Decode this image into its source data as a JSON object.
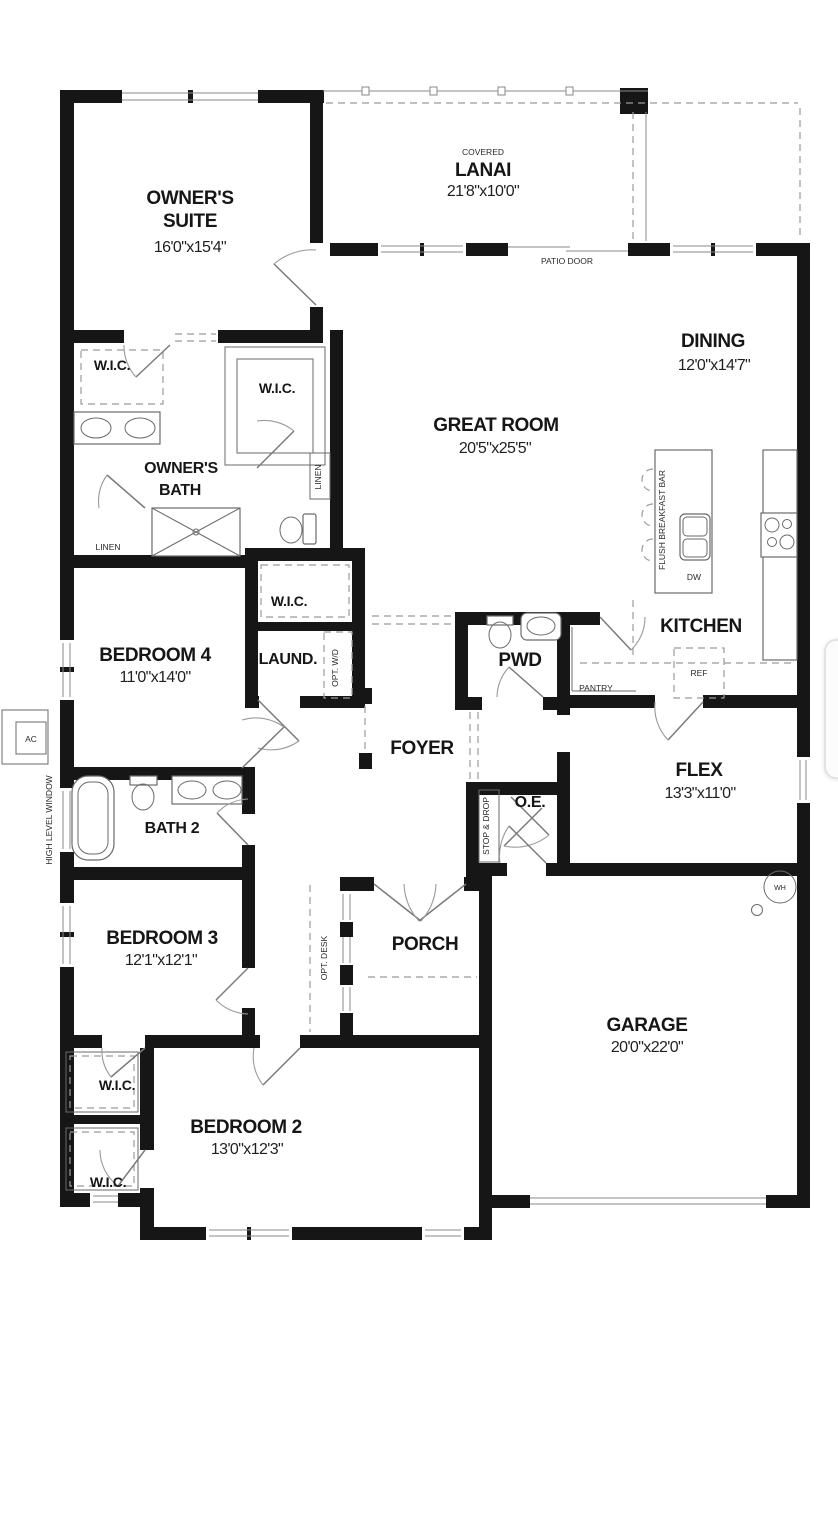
{
  "colors": {
    "background": "#ffffff",
    "wall": "#161616",
    "thin_line": "#8a8a8a",
    "dashed_line": "#9b9b9b",
    "text": "#161616",
    "overlay_border": "#e3e3e3"
  },
  "labels": {
    "owners_suite": {
      "name1": "OWNER'S",
      "name2": "SUITE",
      "dims": "16'0\"x15'4\""
    },
    "lanai": {
      "prefix": "COVERED",
      "name": "LANAI",
      "dims": "21'8\"x10'0\""
    },
    "patio_door": "PATIO DOOR",
    "dining": {
      "name": "DINING",
      "dims": "12'0\"x14'7\""
    },
    "great_room": {
      "name": "GREAT ROOM",
      "dims": "20'5\"x25'5\""
    },
    "kitchen": {
      "name": "KITCHEN"
    },
    "breakfast_bar": "FLUSH BREAKFAST BAR",
    "dw": "DW",
    "ref": "REF",
    "pantry": "PANTRY",
    "wic": "W.I.C.",
    "owners_bath": {
      "name1": "OWNER'S",
      "name2": "BATH"
    },
    "linen": "LINEN",
    "bedroom4": {
      "name": "BEDROOM 4",
      "dims": "11'0\"x14'0\""
    },
    "laundry": {
      "name": "LAUND.",
      "opt": "OPT. W/D"
    },
    "pwd": "PWD",
    "foyer": "FOYER",
    "flex": {
      "name": "FLEX",
      "dims": "13'3\"x11'0\""
    },
    "oe": {
      "name": "O.E.",
      "closet": "STOP & DROP"
    },
    "bath2": "BATH 2",
    "bedroom3": {
      "name": "BEDROOM 3",
      "dims": "12'1\"x12'1\"",
      "opt": "OPT. DESK"
    },
    "porch": "PORCH",
    "garage": {
      "name": "GARAGE",
      "dims": "20'0\"x22'0\"",
      "wh": "WH"
    },
    "bedroom2": {
      "name": "BEDROOM 2",
      "dims": "13'0\"x12'3\""
    },
    "high_level_window": "HIGH LEVEL WINDOW",
    "ac": "AC"
  }
}
